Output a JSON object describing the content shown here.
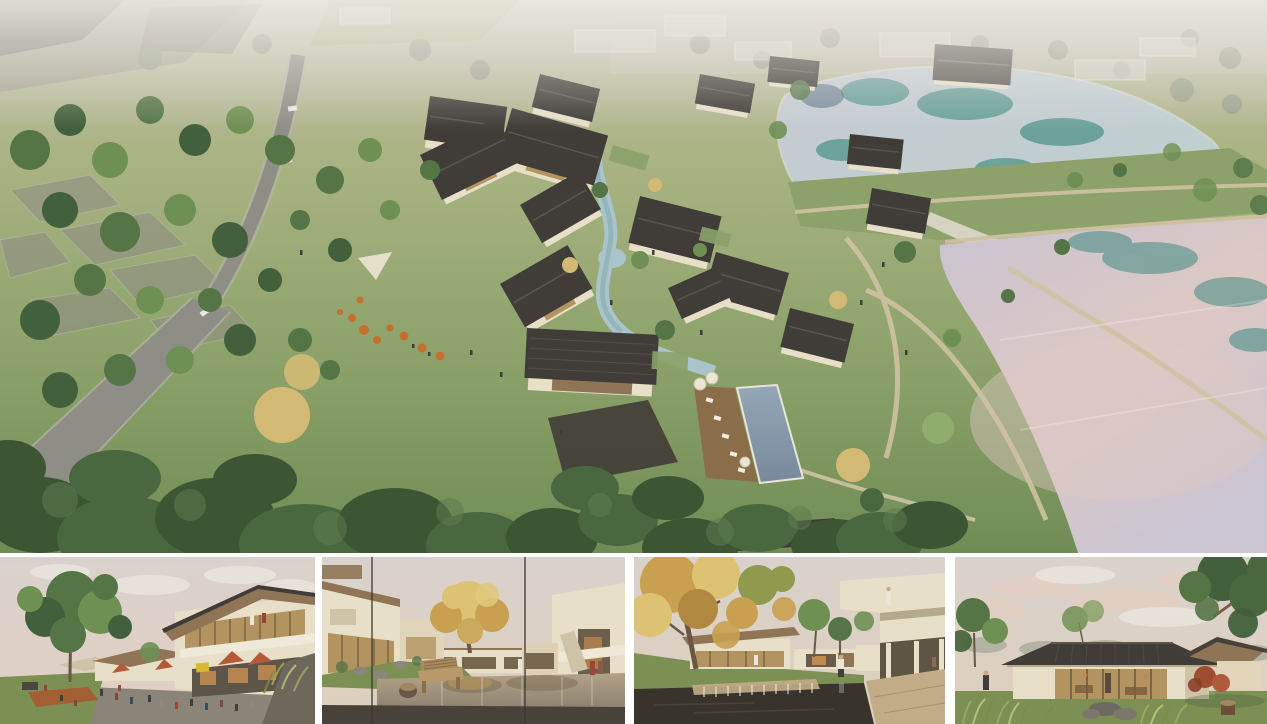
{
  "gallery": {
    "hero": {
      "name": "aerial-masterplan-rendering",
      "description": "Bird's-eye rendering of a resort village: dark gabled-roof houses clustered around a winding stream and pool, green meadows and woods, a curving grey road on the left, translucent massing blocks beyond, and two large ponds separated by a grass dam on the right"
    },
    "thumbnails": [
      {
        "name": "street-plaza-rendering",
        "description": "Eye-level view of a two-storey retail street with timber-soffit roofs, red cafe umbrellas, outdoor seating crowd, large green tree and corten planter"
      },
      {
        "name": "pond-courtyard-rendering",
        "description": "Courtyard seen through glass: reflecting pond, golden tree, cream houses, timber bench armchair with stump stool on a dark deck"
      },
      {
        "name": "waterfall-garden-rendering",
        "description": "Garden court with dark pond and stone weir, autumn plane tree, cantilevered cream balcony with onlooker and stone pavement"
      },
      {
        "name": "pavilion-lawn-rendering",
        "description": "Single-storey glass pavilion with dark hip roof on a lawn at dusk, flanked by trees, red maple, ornamental grasses and a tree stump"
      }
    ]
  },
  "colors": {
    "hazeField": "#c6c2b4",
    "grassLight": "#aab383",
    "grassMid": "#8ca26a",
    "grassDeep": "#708c55",
    "fieldGrey": "#a29e92",
    "plotGrey": "#8f8c83",
    "plotDark": "#7b7970",
    "treeHaze": "#99a08c",
    "treeDark": "#42603b",
    "treeMid": "#567547",
    "treeLight": "#6f9053",
    "treeBright": "#8fae6d",
    "treeGold": "#d3ba74",
    "canopyDark": "#3c5634",
    "canopyMid": "#4a6840",
    "canopyLight": "#5d7c4e",
    "road": "#8e8d86",
    "roadEdge": "#b7b4aa",
    "carWhite": "#e8e8e4",
    "carDark": "#55534e",
    "roofDark": "#403d38",
    "roofLight": "#5a564f",
    "wallCream": "#e8dfc8",
    "wallShade": "#cfc3a7",
    "ghost": "#d8d6cf",
    "stream": "#a9c4cb",
    "streamTeal": "#7fa8a8",
    "lakeUpperA": "#c6cad1",
    "lakeUpperB": "#bdd1d0",
    "lakeTeal": "#3f8a7f",
    "lakeNavy": "#3c5470",
    "lakeLowerA": "#c8c4d1",
    "lakeLowerB": "#cbc5d1",
    "lakePink": "#ddc8c4",
    "pathTan": "#cfc2a2",
    "pool": "#77899b",
    "poolLight": "#95a7b6",
    "deckWood": "#8a6e49",
    "deckLight": "#bd9c6e",
    "orange": "#c4712f",
    "corten": "#a35f33",
    "sail": "#e9e2cf",
    "umbCream": "#ece5d2",
    "skyPanel": "#d9d2cc",
    "skyWarm": "#decfbc",
    "cloudPink": "#e3cec1",
    "cloudWhite": "#efece6",
    "woodSoffit": "#8f7555",
    "glassWarm": "#b3935f",
    "interiorGlow": "#c08a4e",
    "storeDark": "#5d5547",
    "signYellow": "#d8b832",
    "umbrellaRed": "#b55a38",
    "pavement": "#8b8478",
    "stoneWall": "#6e675c",
    "lawnPanel": "#7c9054",
    "pondTanA": "#b3a288",
    "pondTanB": "#8d8170",
    "deckDark": "#48423a",
    "benchWood": "#a8895d",
    "trunk": "#6b5844",
    "pondDark": "#39342b",
    "stonePave": "#c2ac87",
    "autumnA": "#c9a050",
    "autumnB": "#dcc272",
    "autumnGreen": "#8f9a4e",
    "mapleRed": "#a04c30",
    "figureDark": "#3f3e3c",
    "figureRed": "#9e4434",
    "figureWhite": "#e9e5dd",
    "mullion": "#3a362f",
    "grassBlade": "#9aa85e",
    "grassBladeLight": "#b5c078",
    "grassBladeDark": "#7e8c4a",
    "rockGrey": "#7d776b",
    "stumpWood": "#6b4f38",
    "stumpTop": "#a08663"
  }
}
